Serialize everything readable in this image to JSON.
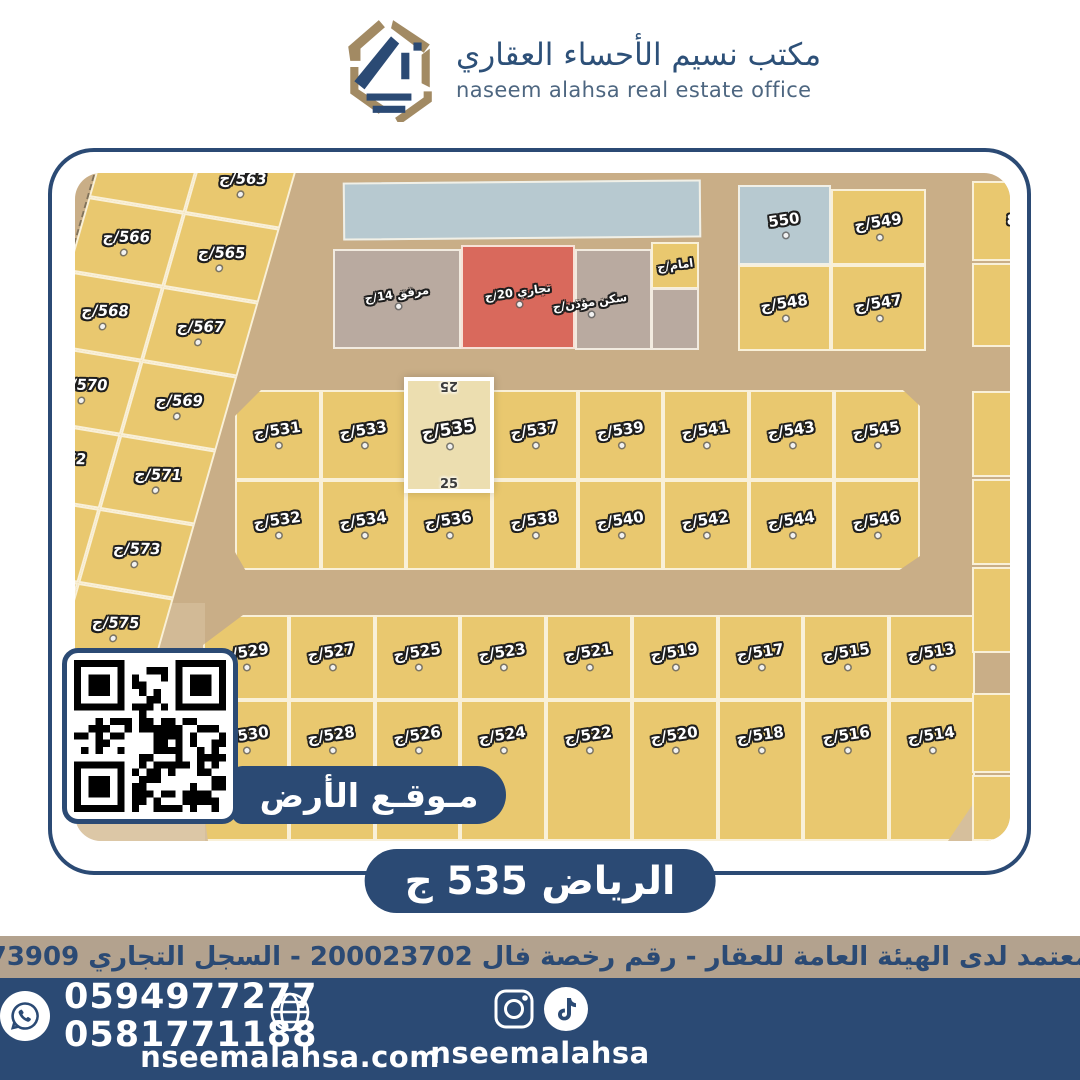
{
  "colors": {
    "navy": "#2b4a74",
    "tan_strip": "#b3a28e",
    "plot_yellow": "#e9c86f",
    "commercial_red": "#d9695c",
    "utility_gray": "#b9aaa0",
    "water_blue": "#b7c9d0",
    "road_tan": "#c9ae87",
    "logo_tan": "#a28a63",
    "highlight_fill": "#ecdeb0"
  },
  "header": {
    "title_ar": "مكتب نسيم الأحساء العقاري",
    "subtitle_en": "naseem alahsa real estate office"
  },
  "map": {
    "diagonal": {
      "left": [
        "",
        "566/ج",
        "568/ج",
        "570/ج",
        "572/ج",
        "574/ج",
        ""
      ],
      "right": [
        "563/ج",
        "565/ج",
        "567/ج",
        "569/ج",
        "571/ج",
        "573/ج",
        "575/ج"
      ]
    },
    "special": {
      "utility": "مرفق 14/ج",
      "commercial": "تجاري 20/ج",
      "imam": "امام/ج",
      "muezzin": "سكن مؤذن/ج"
    },
    "corner": {
      "p550": "550",
      "p549": "549/ج",
      "p548": "548/ج",
      "p547": "547/ج"
    },
    "middle": {
      "row1": [
        "531/ج",
        "533/ج",
        "537/ج",
        "539/ج",
        "541/ج",
        "543/ج",
        "545/ج"
      ],
      "row2": [
        "532/ج",
        "534/ج",
        "536/ج",
        "538/ج",
        "540/ج",
        "542/ج",
        "544/ج",
        "546/ج"
      ]
    },
    "bottom": {
      "row1": [
        "529/ج",
        "527/ج",
        "525/ج",
        "523/ج",
        "521/ج",
        "519/ج",
        "517/ج",
        "515/ج",
        "513/ج"
      ],
      "row2": [
        "530/ج",
        "528/ج",
        "526/ج",
        "524/ج",
        "522/ج",
        "520/ج",
        "518/ج",
        "516/ج",
        "514/ج"
      ]
    },
    "highlight": {
      "plot": "535/ج",
      "dim_top": "25",
      "dim_bottom": "25"
    },
    "edge_fragment": "8"
  },
  "location_banner": "مـوقـع الأرض",
  "title_pill": "الرياض 535 ج",
  "disclaimer": "مسوق معتمد لدى الهيئة العامة للعقار - رقم رخصة فال 200023702 - السجل التجاري 2250373909",
  "footer": {
    "website": "nseemalahsa.com",
    "social_handle": "nseemalahsa",
    "phone1": "0594977277",
    "phone2": "0581771188"
  }
}
